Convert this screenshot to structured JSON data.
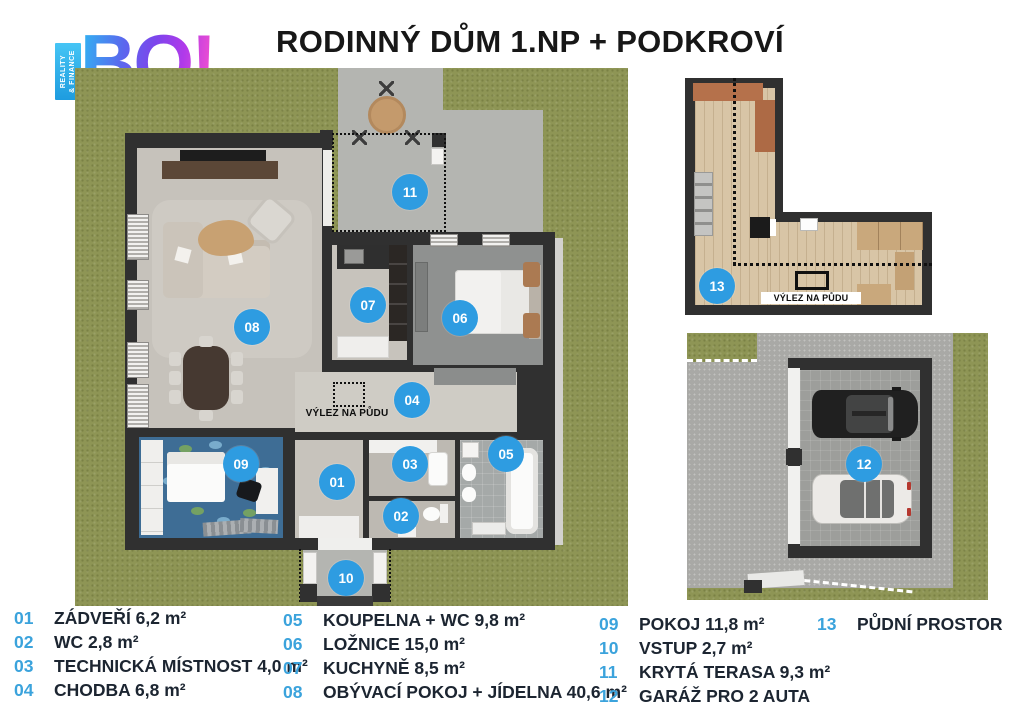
{
  "logo": {
    "tagline1": "REALITY",
    "tagline2": "& FINANCE",
    "wordmark": "BO!"
  },
  "header": {
    "title": "RODINNÝ DŮM 1.NP + PODKROVÍ"
  },
  "markers": {
    "m01": "01",
    "m02": "02",
    "m03": "03",
    "m04": "04",
    "m05": "05",
    "m06": "06",
    "m07": "07",
    "m08": "08",
    "m09": "09",
    "m10": "10",
    "m11": "11",
    "m12": "12",
    "m13": "13"
  },
  "labels": {
    "attic_hatch_main": "VÝLEZ NA PŮDU",
    "attic_hatch_attic": "VÝLEZ NA PŮDU"
  },
  "legend": {
    "columns": [
      {
        "items": [
          {
            "num": "01",
            "label": "ZÁDVEŘÍ 6,2 m²"
          },
          {
            "num": "02",
            "label": "WC 2,8 m²"
          },
          {
            "num": "03",
            "label": "TECHNICKÁ MÍSTNOST 4,0 m²"
          },
          {
            "num": "04",
            "label": "CHODBA 6,8 m²"
          }
        ]
      },
      {
        "items": [
          {
            "num": "05",
            "label": "KOUPELNA + WC 9,8 m²"
          },
          {
            "num": "06",
            "label": "LOŽNICE 15,0 m²"
          },
          {
            "num": "07",
            "label": "KUCHYNĚ 8,5 m²"
          },
          {
            "num": "08",
            "label": "OBÝVACÍ POKOJ + JÍDELNA 40,6 m²"
          }
        ]
      },
      {
        "items": [
          {
            "num": "09",
            "label": "POKOJ 11,8 m²"
          },
          {
            "num": "10",
            "label": "VSTUP 2,7 m²"
          },
          {
            "num": "11",
            "label": "KRYTÁ TERASA 9,3 m²"
          },
          {
            "num": "12",
            "label": "GARÁŽ PRO 2 AUTA"
          }
        ]
      },
      {
        "items": [
          {
            "num": "13",
            "label": "PŮDNÍ PROSTOR"
          }
        ]
      }
    ]
  },
  "colors": {
    "marker_blue": "#2e9ce1",
    "legend_number_blue": "#3ba3dc",
    "grass_green": "#8e9555",
    "wall_dark": "#303030"
  }
}
